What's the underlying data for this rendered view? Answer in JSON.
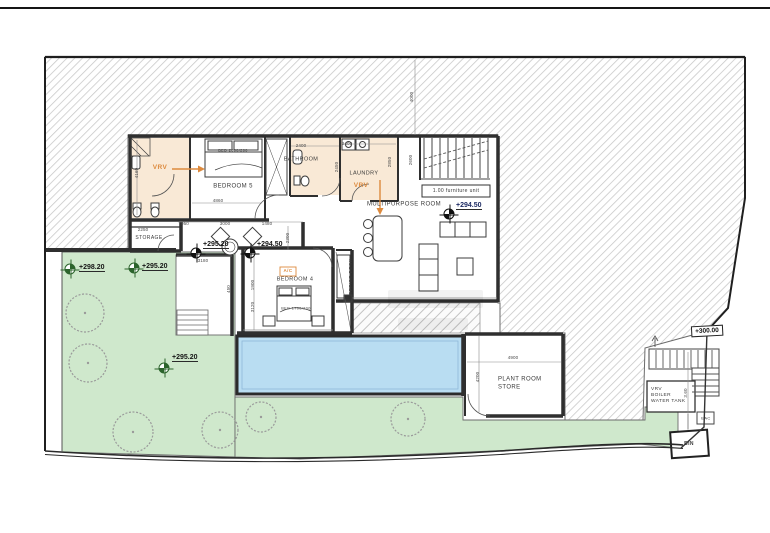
{
  "drawing": {
    "kind": "architectural floor plan"
  },
  "colors": {
    "garden": "#cfe8cc",
    "pool": "#b9ddf2",
    "room_tan": "#f9e9d6",
    "hatch_line": "#c6c6c6",
    "wall": "#2f2f2f",
    "orange": "#dd8a3d",
    "navy": "#1d2a63",
    "marker_green": "#2c642c"
  },
  "room_labels": [
    {
      "name": "room-label-bedroom-5",
      "text": "BEDROOM 5",
      "x": 233,
      "y": 187,
      "fs": 6
    },
    {
      "name": "room-label-bathroom",
      "text": "BATHROOM",
      "x": 301,
      "y": 160,
      "fs": 5.5
    },
    {
      "name": "room-label-laundry",
      "text": "LAUNDRY",
      "x": 364,
      "y": 174,
      "fs": 5.5
    },
    {
      "name": "room-label-multipurpose-room",
      "text": "MULTIPURPOSE ROOM",
      "x": 404,
      "y": 205,
      "fs": 6
    },
    {
      "name": "room-label-bedroom-4",
      "text": "BEDROOM 4",
      "x": 295,
      "y": 280,
      "fs": 5.5
    },
    {
      "name": "room-label-storage",
      "text": "STORAGE",
      "x": 149,
      "y": 238,
      "fs": 5
    },
    {
      "name": "room-label-plant-room-store",
      "text": "PLANT ROOM\nSTORE",
      "x": 498,
      "y": 384,
      "fs": 6,
      "align": "left"
    },
    {
      "name": "room-label-vrv-boiler-water-tank",
      "text": "VRV\nBOILER\nWATER TANK",
      "x": 651,
      "y": 396,
      "fs": 4.8,
      "align": "left"
    },
    {
      "name": "room-label-office-desk",
      "text": "OFFICE DESK",
      "x": 352,
      "y": 277,
      "fs": 4.8,
      "rot": true
    },
    {
      "name": "label-bin",
      "text": "BIN",
      "x": 689,
      "y": 444,
      "fs": 5,
      "bold": true
    },
    {
      "name": "label-eac",
      "text": "EAC",
      "x": 706,
      "y": 418,
      "fs": 4
    },
    {
      "name": "furniture-label-bed-5",
      "text": "BED 2000/200",
      "x": 233,
      "y": 151,
      "fs": 3.8
    },
    {
      "name": "furniture-label-bed-4",
      "text": "BED 1700/200",
      "x": 296,
      "y": 309,
      "fs": 3.8
    },
    {
      "name": "note-furniture-unit",
      "text": "1.00 furniture unit",
      "x": 456,
      "y": 191,
      "fs": 5
    }
  ],
  "equipment_labels": [
    {
      "name": "vrv-label-ensuite",
      "text": "VRV",
      "x": 160,
      "y": 168,
      "fs": 6.5
    },
    {
      "name": "vrv-label-laundry",
      "text": "VRV",
      "x": 361,
      "y": 186,
      "fs": 6.5
    },
    {
      "name": "ac-label-bedroom-4",
      "text": "A/C",
      "x": 288,
      "y": 271,
      "fs": 4.5
    }
  ],
  "dimensions": [
    {
      "text": "4000",
      "x": 412,
      "y": 97,
      "rot": true
    },
    {
      "text": "2400",
      "x": 301,
      "y": 146
    },
    {
      "text": "2400",
      "x": 347,
      "y": 144
    },
    {
      "text": "2850",
      "x": 390,
      "y": 162,
      "rot": true
    },
    {
      "text": "2450",
      "x": 337,
      "y": 167,
      "rot": true
    },
    {
      "text": "2600",
      "x": 411,
      "y": 160,
      "rot": true
    },
    {
      "text": "4860",
      "x": 218,
      "y": 201
    },
    {
      "text": "4160",
      "x": 137,
      "y": 173,
      "rot": true
    },
    {
      "text": "950",
      "x": 185,
      "y": 224
    },
    {
      "text": "3000",
      "x": 225,
      "y": 224
    },
    {
      "text": "1480",
      "x": 267,
      "y": 224
    },
    {
      "text": "2250",
      "x": 143,
      "y": 230
    },
    {
      "text": "2300",
      "x": 288,
      "y": 238,
      "rot": true
    },
    {
      "text": "3180",
      "x": 203,
      "y": 261
    },
    {
      "text": "450",
      "x": 229,
      "y": 289,
      "rot": true
    },
    {
      "text": "1900",
      "x": 253,
      "y": 285,
      "rot": true
    },
    {
      "text": "3120",
      "x": 253,
      "y": 307,
      "rot": true
    },
    {
      "text": "4900",
      "x": 513,
      "y": 358
    },
    {
      "text": "4200",
      "x": 478,
      "y": 377,
      "rot": true
    },
    {
      "text": "3.60",
      "x": 686,
      "y": 393,
      "rot": true
    }
  ],
  "spot_levels": [
    {
      "label": "+298.20",
      "marker_x": 70,
      "marker_y": 269,
      "text_x": 79,
      "text_y": 272,
      "style": "green"
    },
    {
      "label": "+295.20",
      "marker_x": 134,
      "marker_y": 268,
      "text_x": 142,
      "text_y": 271,
      "style": "green"
    },
    {
      "label": "+295.20",
      "marker_x": 196,
      "marker_y": 253,
      "text_x": 203,
      "text_y": 249,
      "style": "black"
    },
    {
      "label": "+294.50",
      "marker_x": 250,
      "marker_y": 253,
      "text_x": 257,
      "text_y": 249,
      "style": "black"
    },
    {
      "label": "+295.20",
      "marker_x": 164,
      "marker_y": 368,
      "text_x": 172,
      "text_y": 362,
      "style": "green"
    },
    {
      "label": "+294.50",
      "marker_x": 449,
      "marker_y": 214,
      "text_x": 456,
      "text_y": 210,
      "style": "navy"
    }
  ],
  "boxed_levels": [
    {
      "label": "+300.00",
      "x": 707,
      "y": 331
    }
  ],
  "trees": [
    {
      "x": 85,
      "y": 313,
      "r": 19
    },
    {
      "x": 88,
      "y": 363,
      "r": 19
    },
    {
      "x": 133,
      "y": 432,
      "r": 20
    },
    {
      "x": 220,
      "y": 430,
      "r": 18
    },
    {
      "x": 261,
      "y": 417,
      "r": 15
    },
    {
      "x": 408,
      "y": 419,
      "r": 17
    }
  ]
}
